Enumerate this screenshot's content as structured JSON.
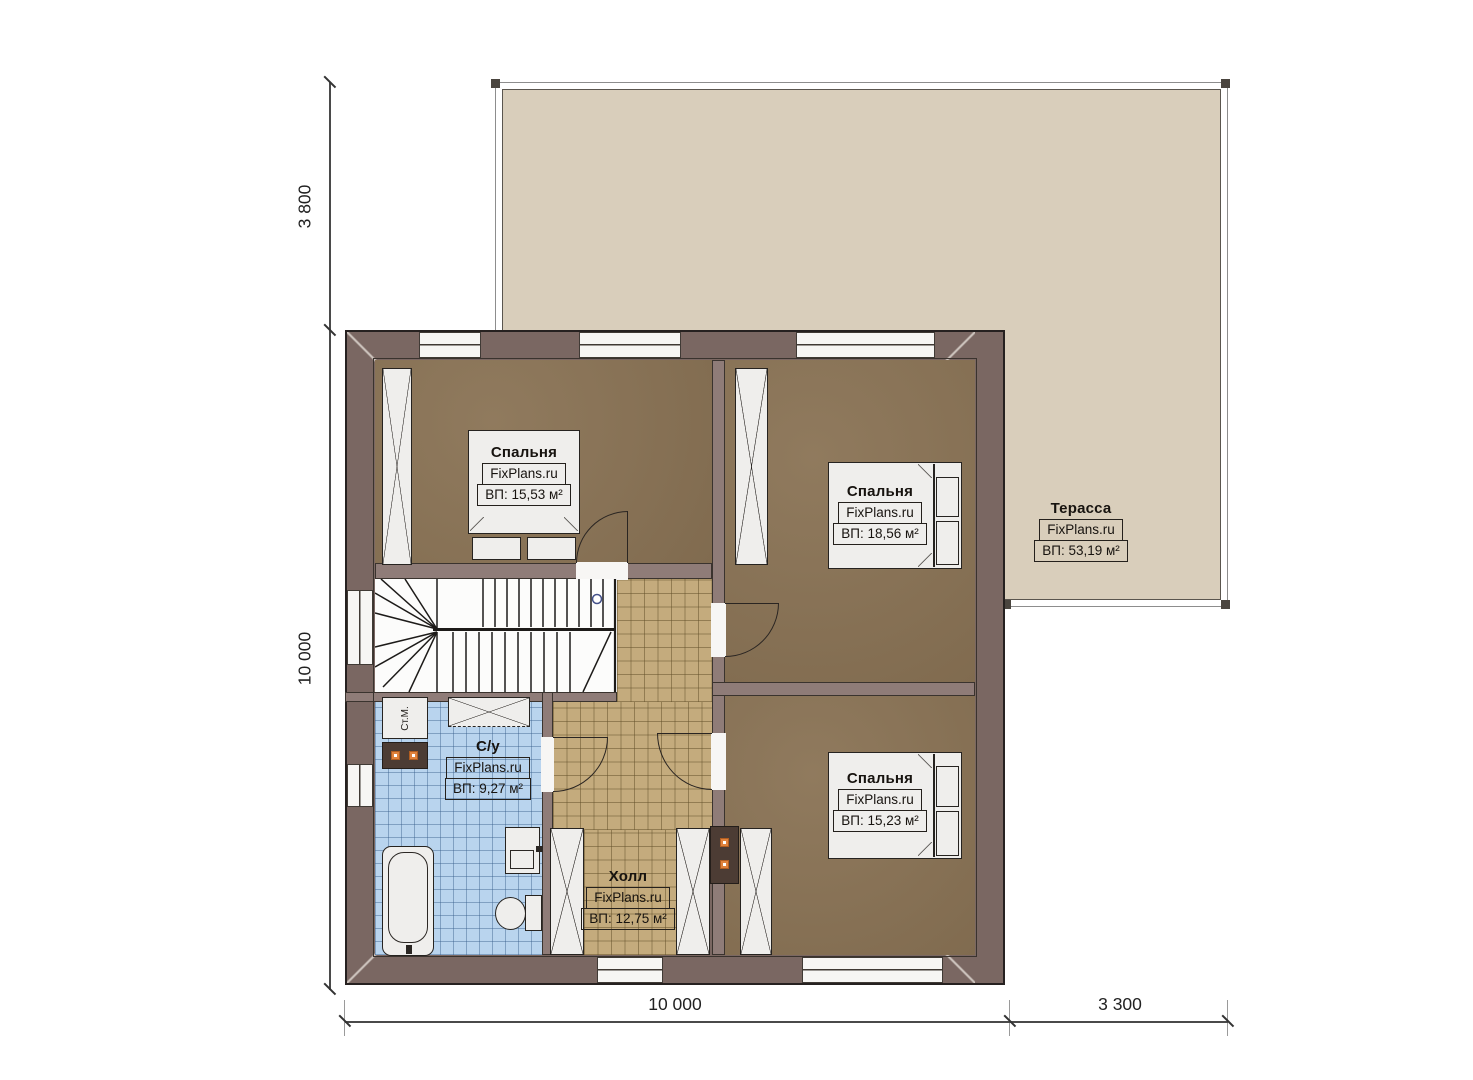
{
  "terrace": {
    "name": "Терасса",
    "brand": "FixPlans.ru",
    "area": "ВП: 53,19 м²"
  },
  "rooms": [
    {
      "id": "bedroom-1",
      "name": "Спальня",
      "brand": "FixPlans.ru",
      "area": "ВП: 15,53 м²"
    },
    {
      "id": "bedroom-2",
      "name": "Спальня",
      "brand": "FixPlans.ru",
      "area": "ВП: 18,56 м²"
    },
    {
      "id": "bedroom-3",
      "name": "Спальня",
      "brand": "FixPlans.ru",
      "area": "ВП: 15,23 м²"
    },
    {
      "id": "bathroom",
      "name": "С/у",
      "brand": "FixPlans.ru",
      "area": "ВП: 9,27 м²"
    },
    {
      "id": "hall",
      "name": "Холл",
      "brand": "FixPlans.ru",
      "area": "ВП: 12,75 м²"
    }
  ],
  "fixtures": {
    "washing_machine": "Ст.М."
  },
  "dimensions": {
    "left_upper": "3 800",
    "left_lower": "10 000",
    "bottom_left": "10 000",
    "bottom_right": "3 300"
  },
  "colors": {
    "terrace_fill": "#d9cebb",
    "outer_wall": "#7a6762",
    "inner_wall": "#8f7c78",
    "bedroom_floor": "#8a7355",
    "hall_floor": "#c4ab7d",
    "bath_floor": "#b9d4ee",
    "accent_orange": "#e0823c"
  }
}
